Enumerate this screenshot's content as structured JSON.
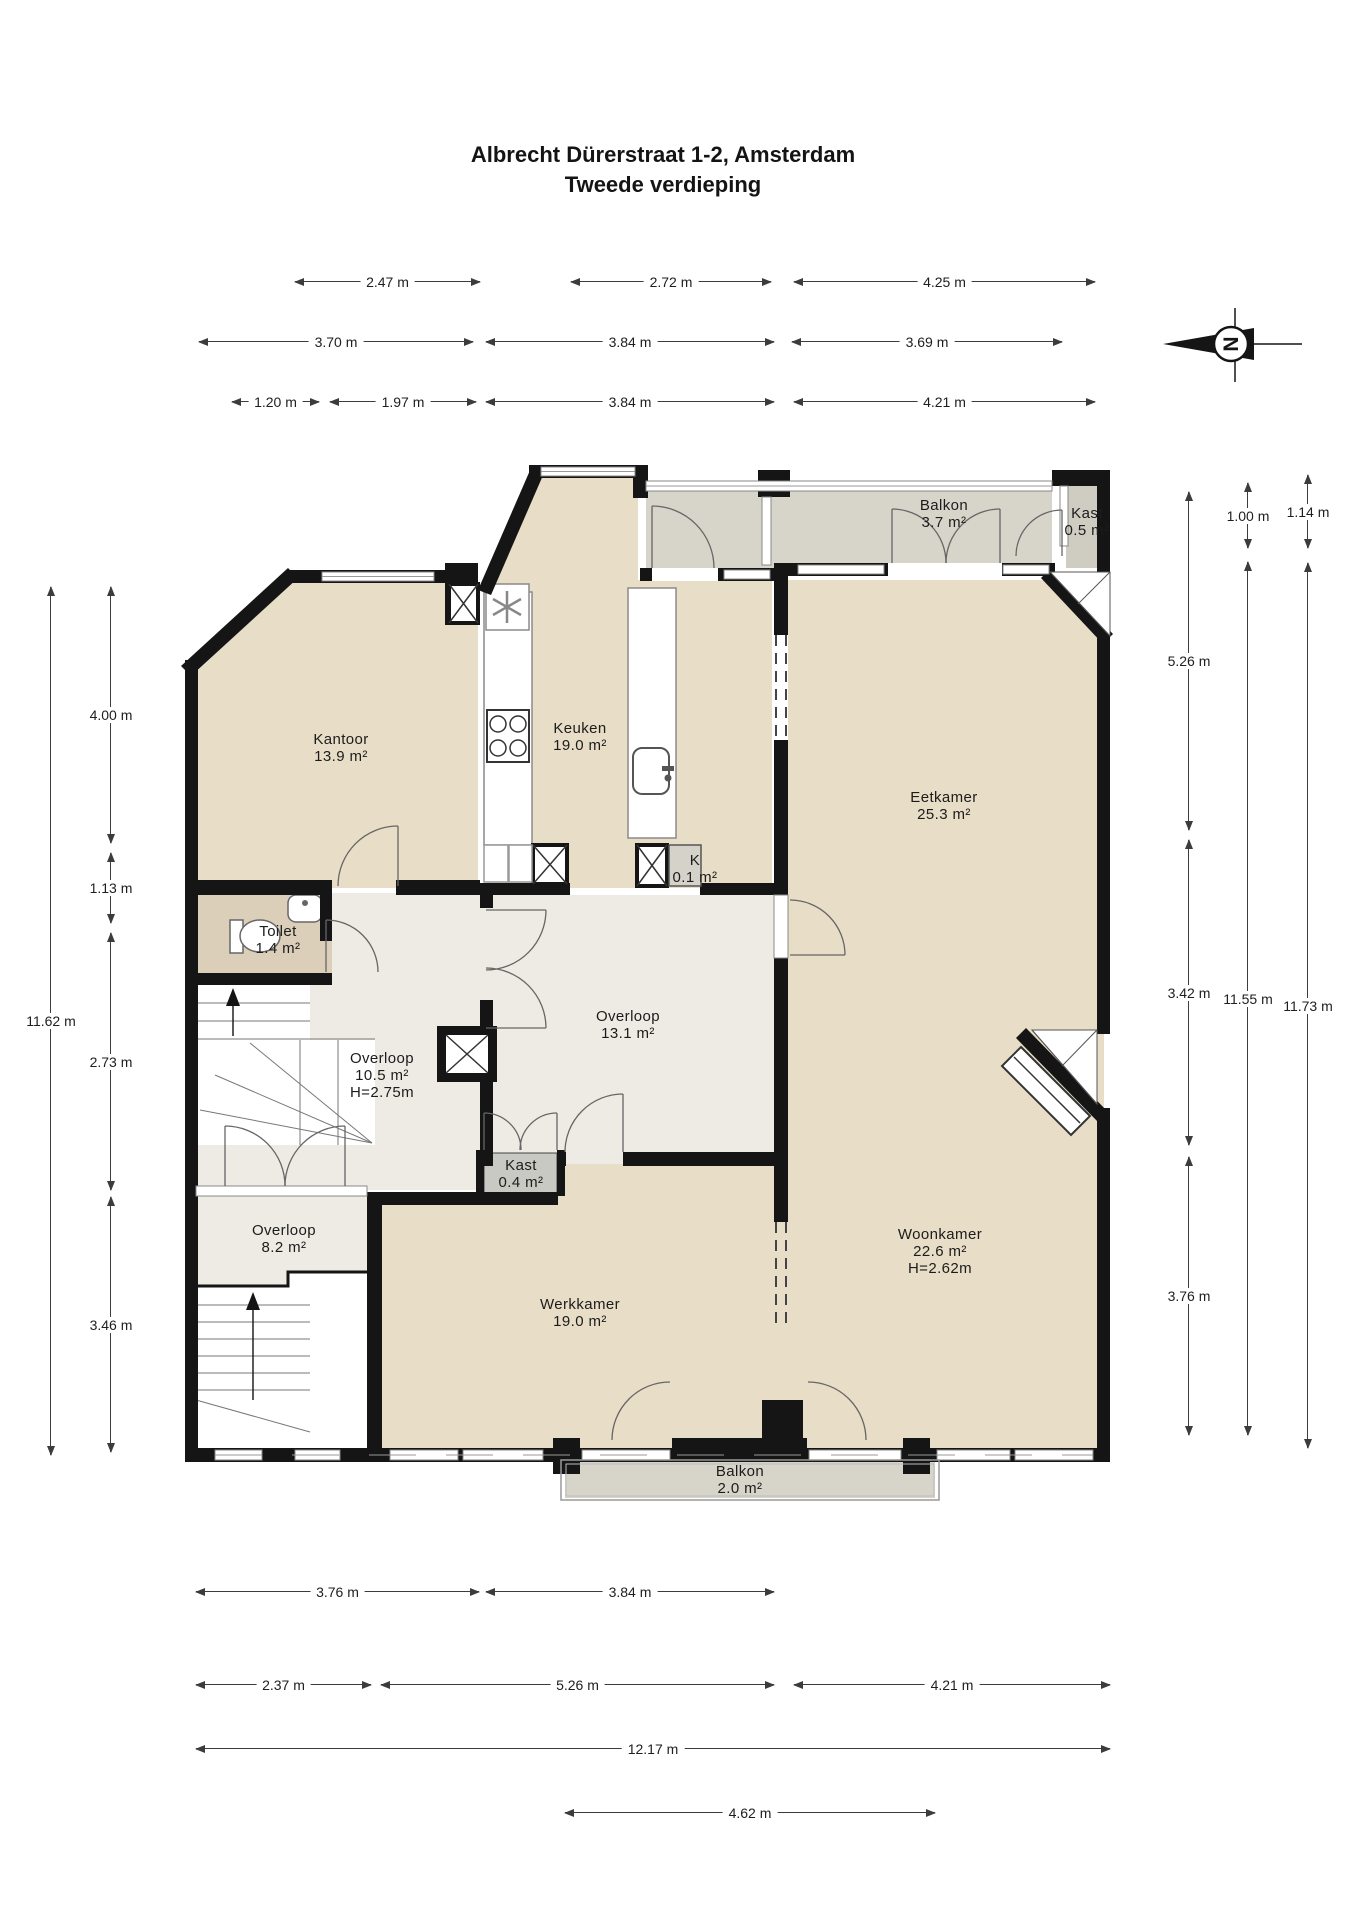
{
  "title": {
    "line1": "Albrecht Dürerstraat 1-2, Amsterdam",
    "line2": "Tweede verdieping"
  },
  "compass": {
    "letter": "N"
  },
  "rooms": {
    "balkon_top": {
      "name": "Balkon",
      "area": "3.7 m²"
    },
    "kast_top": {
      "name": "Kast",
      "area": "0.5 m²"
    },
    "kantoor": {
      "name": "Kantoor",
      "area": "13.9 m²"
    },
    "keuken": {
      "name": "Keuken",
      "area": "19.0 m²"
    },
    "eetkamer": {
      "name": "Eetkamer",
      "area": "25.3 m²"
    },
    "k_closet": {
      "name": "K",
      "area": "0.1 m²"
    },
    "toilet": {
      "name": "Toilet",
      "area": "1.4 m²"
    },
    "overloop_left": {
      "name": "Overloop",
      "area": "10.5 m²",
      "height": "H=2.75m"
    },
    "overloop_mid": {
      "name": "Overloop",
      "area": "13.1 m²"
    },
    "kast_small": {
      "name": "Kast",
      "area": "0.4 m²"
    },
    "overloop_bottom": {
      "name": "Overloop",
      "area": "8.2 m²"
    },
    "werkkamer": {
      "name": "Werkkamer",
      "area": "19.0 m²"
    },
    "woonkamer": {
      "name": "Woonkamer",
      "area": "22.6 m²",
      "height": "H=2.62m"
    },
    "balkon_bottom": {
      "name": "Balkon",
      "area": "2.0 m²"
    }
  },
  "dims": {
    "top": [
      "2.47 m",
      "2.72 m",
      "4.25 m",
      "3.70 m",
      "3.84 m",
      "3.69 m",
      "1.20 m",
      "1.97 m",
      "3.84 m",
      "4.21 m"
    ],
    "bottom": [
      "3.76 m",
      "3.84 m",
      "2.37 m",
      "5.26 m",
      "4.21 m",
      "12.17 m",
      "4.62 m"
    ],
    "left": [
      "11.62 m",
      "4.00 m",
      "1.13 m",
      "2.73 m",
      "3.46 m"
    ],
    "right": [
      "5.26 m",
      "3.42 m",
      "3.76 m",
      "1.00 m",
      "11.55 m",
      "1.14 m",
      "11.73 m"
    ]
  },
  "colors": {
    "room_beige": "#e8ddc6",
    "hall_gray": "#edebe4",
    "toilet_tan": "#dccfba",
    "balcony_gray": "#d7d4ca",
    "wall_black": "#151515"
  }
}
